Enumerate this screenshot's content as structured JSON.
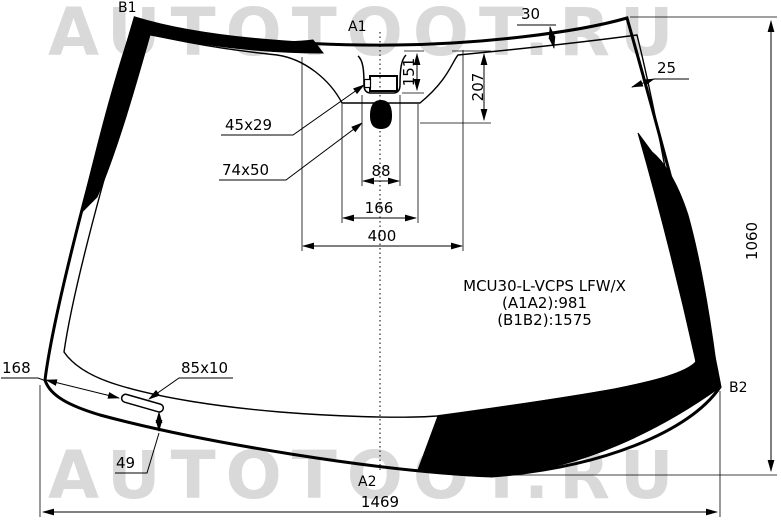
{
  "watermark": {
    "text": "AUTOTOOT.RU"
  },
  "part_info": {
    "part_number": "MCU30-L-VCPS LFW/X",
    "a1a2_distance": "(A1A2):981",
    "b1b2_distance": "(B1B2):1575"
  },
  "reference_points": {
    "top_left": "B1",
    "top_center": "A1",
    "bottom_center": "A2",
    "bottom_right": "B2"
  },
  "dimensions": {
    "top_band_width": "30",
    "side_band_width": "25",
    "sensor_depth": "151",
    "mirror_depth": "207",
    "sensor_window_span": "88",
    "cover_span": "166",
    "cover_total_span": "400",
    "sensor_window_size": "45x29",
    "mirror_button_size": "74x50",
    "glass_height": "1060",
    "slot_offset": "168",
    "slot_size": "85x10",
    "slot_to_edge": "49",
    "bottom_width": "1469"
  },
  "colors": {
    "line": "#000000",
    "watermark": "#d9d9d9",
    "background": "#ffffff"
  }
}
